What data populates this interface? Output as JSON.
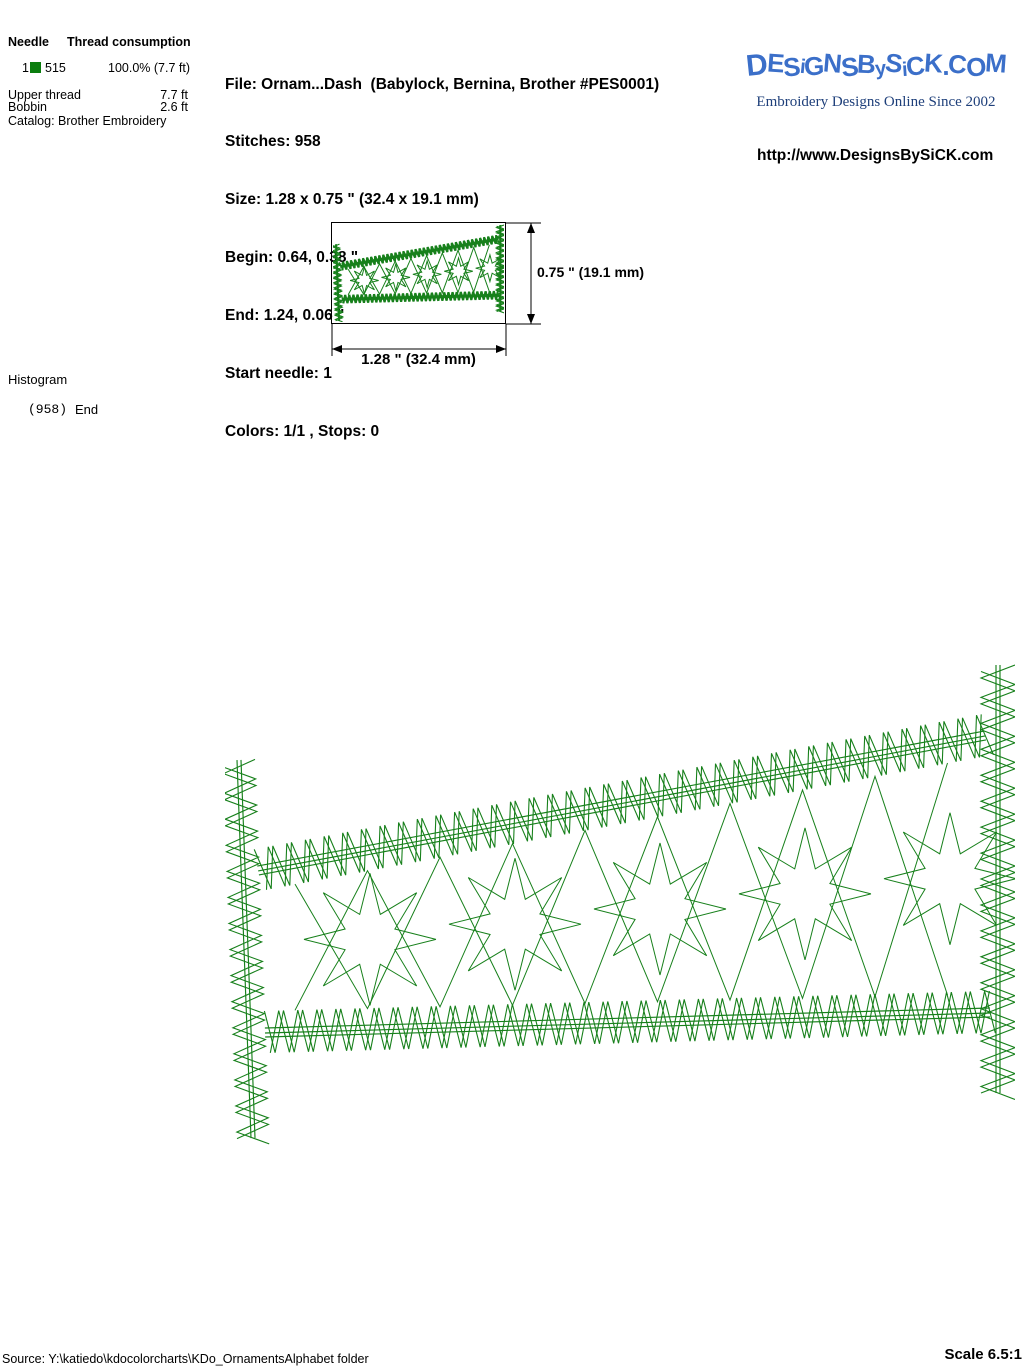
{
  "thread_table": {
    "col_needle": "Needle",
    "col_consumption": "Thread consumption",
    "rows": [
      {
        "needle": "1",
        "color": "#0b7d0e",
        "thread_number": "515",
        "consumption": "100.0% (7.7 ft)"
      }
    ],
    "upper_thread_label": "Upper thread",
    "upper_thread_value": "7.7 ft",
    "bobbin_label": "Bobbin",
    "bobbin_value": "2.6 ft",
    "catalog_line": "Catalog: Brother Embroidery"
  },
  "file_info": {
    "lines": [
      "File: Ornam...Dash  (Babylock, Bernina, Brother #PES0001)",
      "Stitches: 958",
      "Size: 1.28 x 0.75 \" (32.4 x 19.1 mm)",
      "Begin: 0.64, 0.38 \"",
      "End: 1.24, 0.06 \"",
      "Start needle: 1",
      "Colors: 1/1 , Stops: 0"
    ]
  },
  "branding": {
    "logo_text": "DESiGNSBySiCK.COM",
    "logo_color": "#3b6fc9",
    "tagline": "Embroidery Designs Online Since 2002",
    "tagline_color": "#1e3f7a",
    "url": "http://www.DesignsBySiCK.com"
  },
  "preview": {
    "height_label": "0.75 \" (19.1 mm)",
    "width_label": "1.28 \" (32.4 mm)"
  },
  "histogram": {
    "title": "Histogram",
    "count": "(958)",
    "end_label": "End"
  },
  "design": {
    "stitch_color": "#17801b"
  },
  "footer": {
    "source_line": "Source: Y:\\katiedo\\kdocolorcharts\\KDo_OrnamentsAlphabet folder",
    "scale_label": "Scale 6.5:1"
  }
}
